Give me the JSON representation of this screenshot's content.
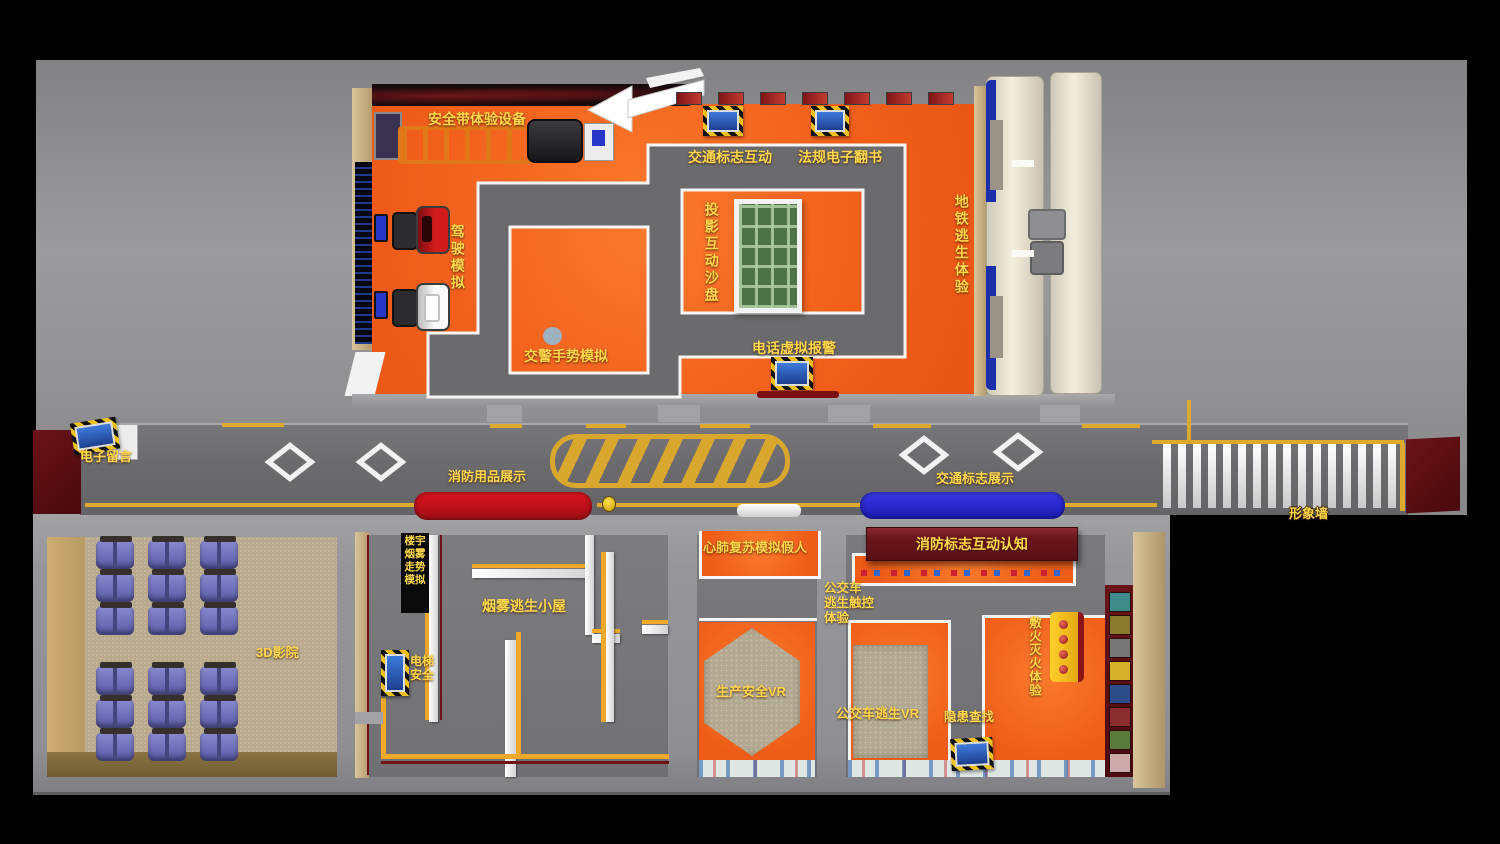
{
  "palette": {
    "floor_orange": "#f2601c",
    "path_gray": "#6b6b6e",
    "label_yellow": "#ffd84d",
    "line_yellow": "#dfa92e",
    "wall_dark_red": "#5a1016",
    "banner_red": "#6b161c",
    "bus_blue": "#2726d8",
    "truck_red": "#c01018",
    "train_cream": "#f4eedd",
    "train_blue": "#1b2fa8",
    "seat_blue": "#6e6ebd",
    "sandbox_green": "#4e7247",
    "cinema_floor": "#b9aa8e",
    "platform_tan": "#b3a890"
  },
  "top_room": {
    "labels": {
      "seatbelt": "安全带体验设备",
      "traffic_sign": "交通标志互动",
      "ebook": "法规电子翻书",
      "sandbox": "投影互动沙盘",
      "subway": "地铁逃生体验",
      "driving": "驾驶模拟",
      "gesture": "交警手势模拟",
      "phone": "电话虚拟报警"
    }
  },
  "corridor": {
    "labels": {
      "message": "电子留言",
      "fire_goods": "消防用品展示",
      "traffic_show": "交通标志展示",
      "image_wall": "形象墙"
    }
  },
  "bottom": {
    "labels": {
      "cinema": "3D影院",
      "smoke_trend": "楼宇\n烟雾\n走势\n模拟",
      "smoke_house": "烟雾逃生小屋",
      "elevator": "电梯\n安全",
      "cpr": "心肺复苏模拟假人",
      "production_vr": "生产安全VR",
      "bus_touch": "公交车\n逃生触控\n体验",
      "bus_vr": "公交车逃生VR",
      "fire_sign": "消防标志互动认知",
      "hazard": "隐患查找",
      "extinguish": "敷火灭火体验"
    }
  },
  "cinema_seating": {
    "blocks": 2,
    "rows": 3,
    "cols": 3
  },
  "zebra": {
    "bars": 16
  },
  "top_wall_posters": {
    "count": 7
  },
  "poster_wall": {
    "count": 8
  },
  "extinguisher_unit": {
    "dots": 4
  }
}
